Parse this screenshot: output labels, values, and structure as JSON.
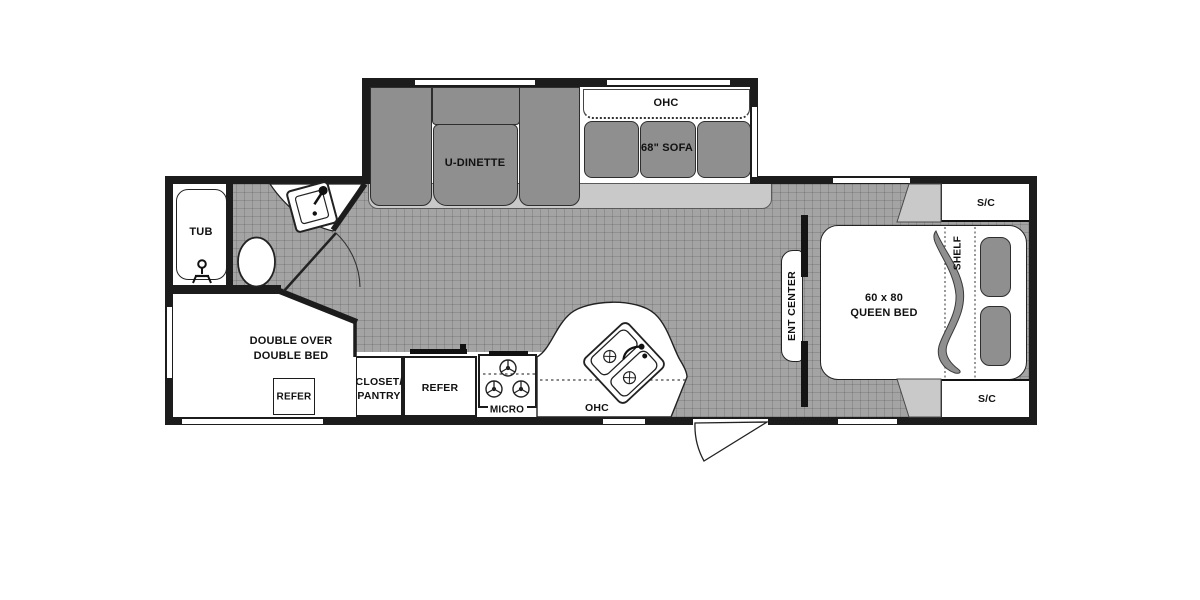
{
  "title": "Travel trailer floor plan",
  "colors": {
    "wall": "#1c1c1c",
    "floor": "#a4a4a4",
    "furniture": "#8f8f8f",
    "slide_floor": "#c9c9c9",
    "background": "#ffffff"
  },
  "plan": {
    "slideout": {
      "ohc": "OHC",
      "sofa": "68\" SOFA",
      "dinette": "U-DINETTE"
    },
    "bath": {
      "tub": "TUB"
    },
    "front_bedroom": {
      "line1": "DOUBLE OVER",
      "line2": "DOUBLE BED",
      "refer": "REFER"
    },
    "kitchen": {
      "closet_line1": "CLOSET/",
      "closet_line2": "PANTRY",
      "refer": "REFER",
      "micro": "MICRO",
      "ohc": "OHC"
    },
    "living": {
      "ent_center": "ENT CENTER"
    },
    "rear_bedroom": {
      "bed_size": "60 x 80",
      "bed": "QUEEN BED",
      "shelf": "SHELF",
      "sc_top": "S/C",
      "sc_bottom": "S/C"
    }
  }
}
